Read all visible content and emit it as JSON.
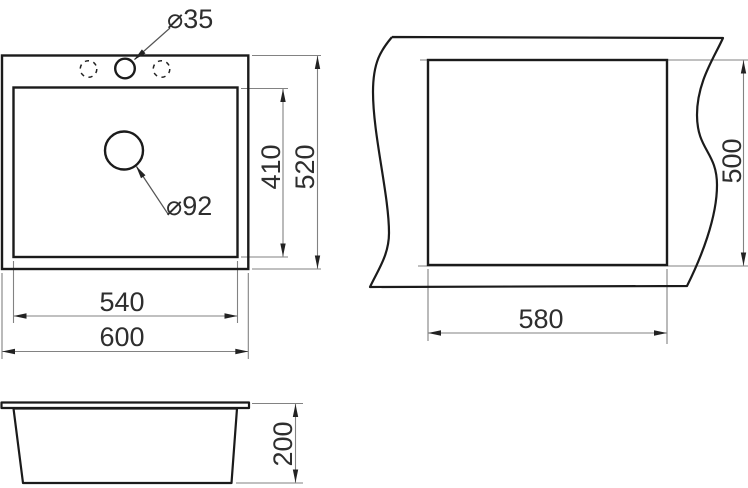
{
  "drawing": {
    "type": "sink-dimension-drawing",
    "top_view": {
      "faucet_hole_diameter": "⌀35",
      "drain_hole_diameter": "⌀92",
      "bowl_length": "410",
      "overall_length": "520",
      "bowl_width": "540",
      "overall_width": "600"
    },
    "cutout_view": {
      "cutout_length": "500",
      "cutout_width": "580"
    },
    "side_view": {
      "height": "200"
    },
    "colors": {
      "object_line": "#1b1b1b",
      "dimension_line": "#828282",
      "arrow": "#222222",
      "text": "#2e2e2e",
      "background": "#ffffff"
    }
  }
}
